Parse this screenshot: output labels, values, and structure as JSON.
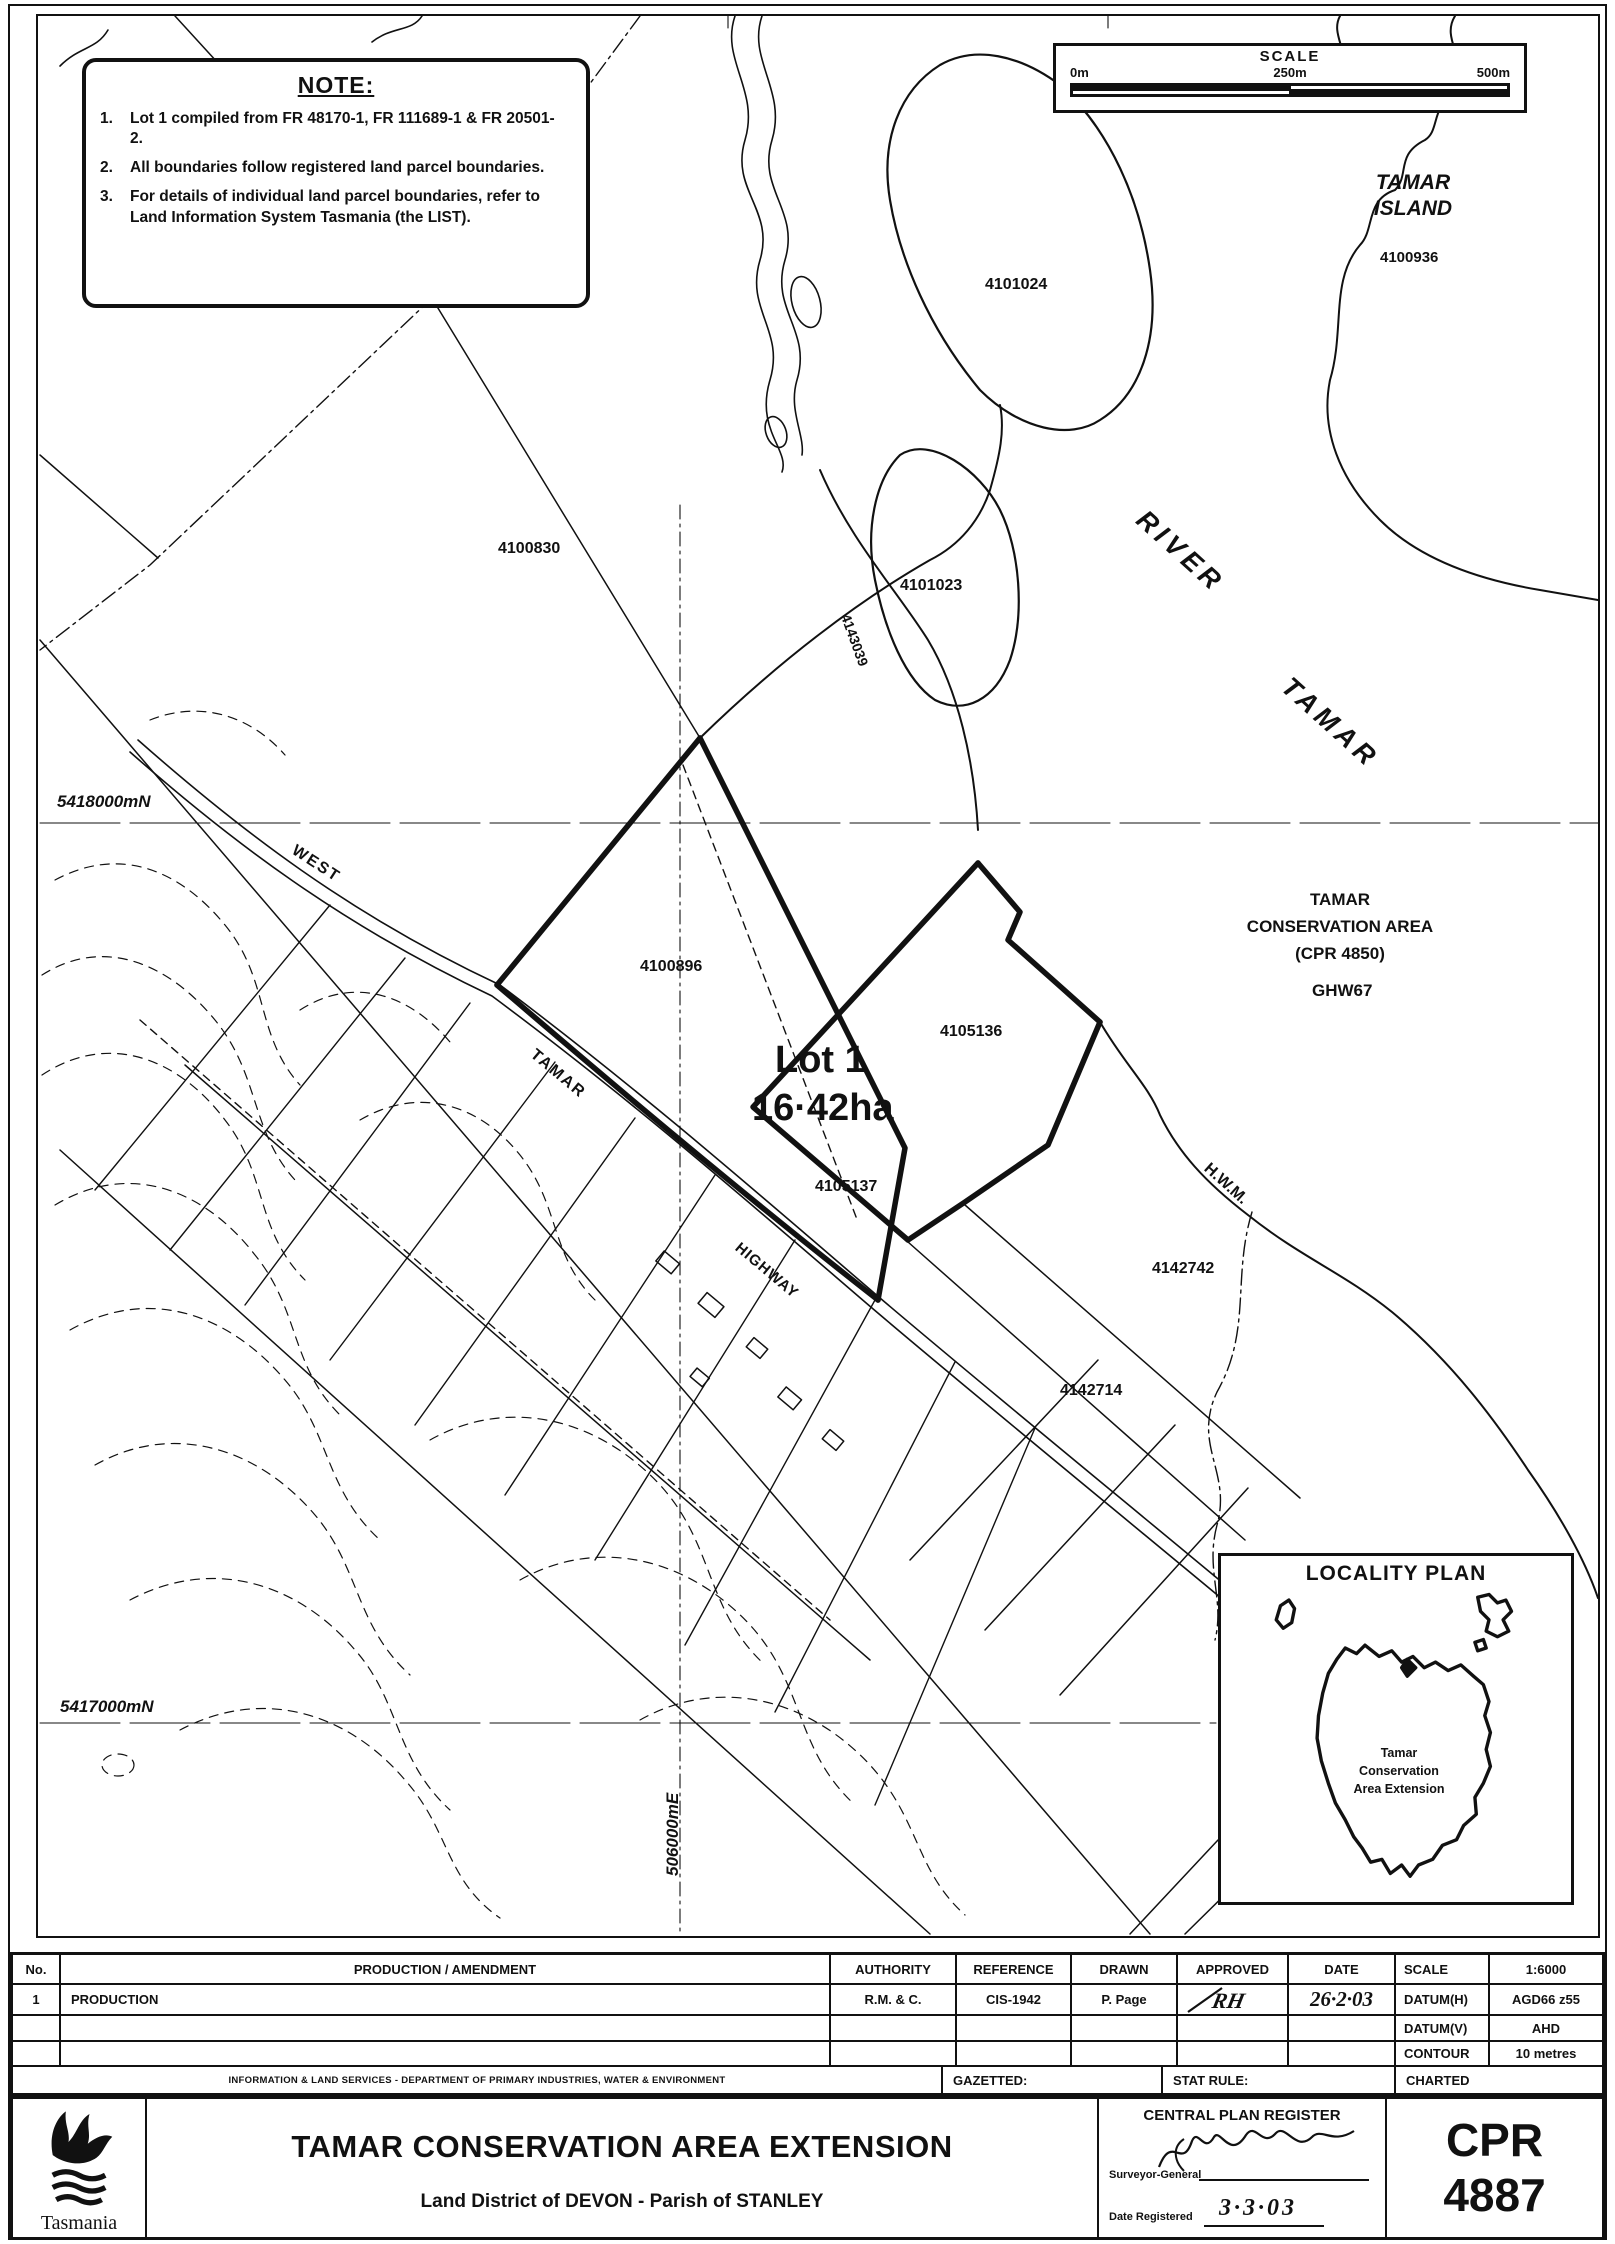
{
  "colors": {
    "ink": "#111111",
    "paper": "#ffffff"
  },
  "note_box": {
    "title": "NOTE:",
    "items": [
      {
        "num": "1.",
        "text": "Lot 1 compiled from FR 48170-1, FR 111689-1 & FR 20501-2."
      },
      {
        "num": "2.",
        "text": "All boundaries follow registered land parcel boundaries."
      },
      {
        "num": "3.",
        "text": "For details of individual land parcel boundaries, refer to Land Information System Tasmania (the LIST)."
      }
    ]
  },
  "scale_bar": {
    "title": "SCALE",
    "tick0": "0m",
    "tick250": "250m",
    "tick500": "500m"
  },
  "map": {
    "labels": {
      "island_name_line1": "TAMAR",
      "island_name_line2": "ISLAND",
      "parcel_4100936": "4100936",
      "parcel_4101024": "4101024",
      "parcel_4100830": "4100830",
      "parcel_4101023": "4101023",
      "parcel_4143039": "4143039",
      "river_word": "RIVER",
      "river_tamar_word": "TAMAR",
      "hwy_west": "WEST",
      "hwy_tamar": "TAMAR",
      "hwy_highway": "HIGHWAY",
      "parcel_4100896": "4100896",
      "lot_name": "Lot 1",
      "lot_area": "16·42ha",
      "parcel_4105136": "4105136",
      "parcel_4105137": "4105137",
      "ca_line1": "TAMAR",
      "ca_line2": "CONSERVATION AREA",
      "ca_line3": "(CPR 4850)",
      "ghw67": "GHW67",
      "hwm": "H.W.M.",
      "parcel_4142742": "4142742",
      "parcel_4142714": "4142714",
      "northing_5418000": "5418000mN",
      "northing_5417000": "5417000mN",
      "easting_506000": "506000mE"
    }
  },
  "locality": {
    "title": "LOCALITY PLAN",
    "callout_line1": "Tamar",
    "callout_line2": "Conservation",
    "callout_line3": "Area Extension"
  },
  "table": {
    "headers": {
      "no": "No.",
      "amendment": "PRODUCTION / AMENDMENT",
      "authority": "AUTHORITY",
      "reference": "REFERENCE",
      "drawn": "DRAWN",
      "approved": "APPROVED",
      "date": "DATE"
    },
    "row1": {
      "no": "1",
      "amendment": "PRODUCTION",
      "authority": "R.M. & C.",
      "reference": "CIS-1942",
      "drawn": "P. Page",
      "approved": "RH",
      "date": "26·2·03"
    },
    "meta": {
      "scale_label": "SCALE",
      "scale_value": "1:6000",
      "datum_h_label": "DATUM(H)",
      "datum_h_value": "AGD66 z55",
      "datum_v_label": "DATUM(V)",
      "datum_v_value": "AHD",
      "contour_label": "CONTOUR",
      "contour_value": "10 metres",
      "charted_label": "CHARTED"
    },
    "footer": {
      "dept": "INFORMATION & LAND SERVICES - DEPARTMENT OF PRIMARY INDUSTRIES, WATER & ENVIRONMENT",
      "gazetted": "GAZETTED:",
      "stat_rule": "STAT RULE:"
    }
  },
  "title_block": {
    "logo_text": "Tasmania",
    "title": "TAMAR CONSERVATION AREA EXTENSION",
    "subtitle": "Land District of DEVON - Parish of STANLEY",
    "register": {
      "heading": "CENTRAL PLAN REGISTER",
      "surveyor_label": "Surveyor-General",
      "date_label": "Date Registered",
      "date_value": "3·3·03"
    },
    "cpr_label": "CPR",
    "cpr_number": "4887"
  }
}
